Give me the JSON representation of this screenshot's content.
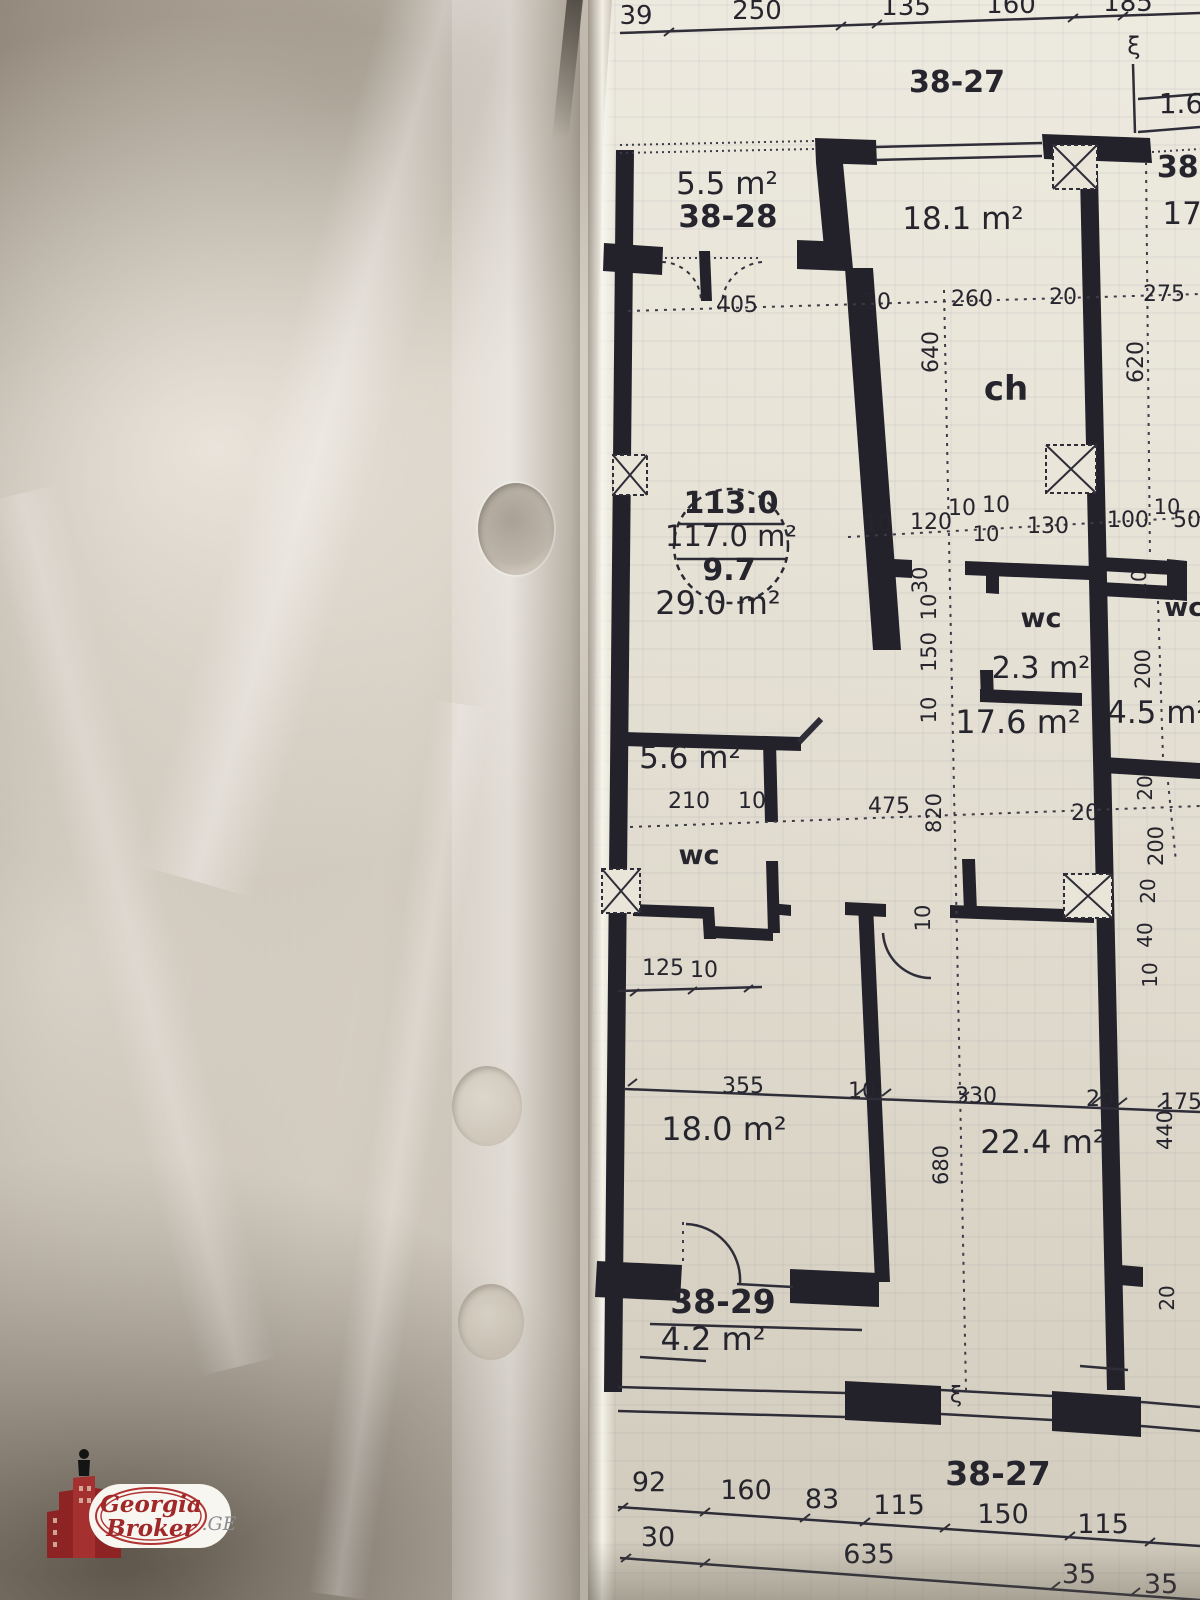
{
  "photo": {
    "description": "floor plan sheet in plastic sleeve"
  },
  "colors": {
    "wall_ink": "#23222b",
    "paper": "#e8e4d8",
    "brand_red": "#9e2727",
    "suffix_gray": "#8d8d94"
  },
  "watermark": {
    "brand_top": "Georgia",
    "brand_bottom": "Broker",
    "suffix": ".GE"
  },
  "plan": {
    "labels": [
      {
        "t": "38-27",
        "x": 957,
        "y": 92,
        "s": 30,
        "b": 1,
        "n": "unit-number-label"
      },
      {
        "t": "1.6",
        "x": 1181,
        "y": 113,
        "s": 28,
        "n": "dimension-label"
      },
      {
        "t": "5.5 m²",
        "x": 727,
        "y": 194,
        "s": 31,
        "n": "room-area-label"
      },
      {
        "t": "38-28",
        "x": 728,
        "y": 227,
        "s": 31,
        "b": 1,
        "n": "unit-number-label"
      },
      {
        "t": "18.1 m²",
        "x": 963,
        "y": 229,
        "s": 31,
        "n": "room-area-label"
      },
      {
        "t": "38-",
        "x": 1184,
        "y": 177,
        "s": 30,
        "b": 1,
        "n": "unit-number-label"
      },
      {
        "t": "17.",
        "x": 1187,
        "y": 224,
        "s": 31,
        "n": "room-area-label"
      },
      {
        "t": "ch",
        "x": 1006,
        "y": 400,
        "s": 34,
        "b": 1,
        "n": "room-name-label"
      },
      {
        "t": "113.0",
        "x": 731,
        "y": 513,
        "s": 30,
        "b": 1,
        "n": "area-stamp-value"
      },
      {
        "t": "117.0 m²",
        "x": 731,
        "y": 546,
        "s": 29,
        "n": "area-stamp-value"
      },
      {
        "t": "9.7",
        "x": 729,
        "y": 580,
        "s": 30,
        "b": 1,
        "n": "area-stamp-value"
      },
      {
        "t": "29.0 m²",
        "x": 718,
        "y": 614,
        "s": 32,
        "n": "room-area-label"
      },
      {
        "t": "wc",
        "x": 1041,
        "y": 627,
        "s": 27,
        "b": 1,
        "n": "room-name-label"
      },
      {
        "t": "2.3 m²",
        "x": 1041,
        "y": 678,
        "s": 30,
        "n": "room-area-label"
      },
      {
        "t": "17.6 m²",
        "x": 1018,
        "y": 733,
        "s": 32,
        "n": "room-area-label"
      },
      {
        "t": "wc",
        "x": 1184,
        "y": 616,
        "s": 26,
        "b": 1,
        "n": "room-name-label"
      },
      {
        "t": "4.5 m²",
        "x": 1158,
        "y": 723,
        "s": 31,
        "n": "room-area-label"
      },
      {
        "t": "5.6 m²",
        "x": 690,
        "y": 768,
        "s": 31,
        "n": "room-area-label"
      },
      {
        "t": "wc",
        "x": 699,
        "y": 864,
        "s": 27,
        "b": 1,
        "n": "room-name-label"
      },
      {
        "t": "18.0 m²",
        "x": 724,
        "y": 1140,
        "s": 32,
        "n": "room-area-label"
      },
      {
        "t": "22.4 m²",
        "x": 1043,
        "y": 1153,
        "s": 32,
        "n": "room-area-label"
      },
      {
        "t": "38-29",
        "x": 723,
        "y": 1313,
        "s": 33,
        "b": 1,
        "n": "unit-number-label"
      },
      {
        "t": "4.2 m²",
        "x": 713,
        "y": 1350,
        "s": 32,
        "n": "room-area-label"
      },
      {
        "t": "38-27",
        "x": 998,
        "y": 1485,
        "s": 33,
        "b": 1,
        "n": "unit-number-label"
      },
      {
        "t": "39",
        "x": 636,
        "y": 24,
        "s": 26
      },
      {
        "t": "250",
        "x": 757,
        "y": 19,
        "s": 26
      },
      {
        "t": "135",
        "x": 906,
        "y": 15,
        "s": 26
      },
      {
        "t": "160",
        "x": 1011,
        "y": 13,
        "s": 26
      },
      {
        "t": "185",
        "x": 1128,
        "y": 11,
        "s": 26
      },
      {
        "t": "405",
        "x": 737,
        "y": 312,
        "s": 22
      },
      {
        "t": "10",
        "x": 877,
        "y": 309,
        "s": 22
      },
      {
        "t": "260",
        "x": 972,
        "y": 306,
        "s": 22
      },
      {
        "t": "20",
        "x": 1063,
        "y": 304,
        "s": 22
      },
      {
        "t": "275",
        "x": 1164,
        "y": 301,
        "s": 22
      },
      {
        "t": "640",
        "x": 938,
        "y": 352,
        "s": 22,
        "r": -90
      },
      {
        "t": "620",
        "x": 1143,
        "y": 362,
        "s": 22,
        "r": -90
      },
      {
        "t": "10",
        "x": 878,
        "y": 531,
        "s": 22
      },
      {
        "t": "120",
        "x": 931,
        "y": 529,
        "s": 22
      },
      {
        "t": "10",
        "x": 962,
        "y": 515,
        "s": 22
      },
      {
        "t": "10",
        "x": 996,
        "y": 512,
        "s": 22
      },
      {
        "t": "10",
        "x": 986,
        "y": 541,
        "s": 21
      },
      {
        "t": "130",
        "x": 1048,
        "y": 533,
        "s": 22
      },
      {
        "t": "100",
        "x": 1128,
        "y": 527,
        "s": 22
      },
      {
        "t": "10",
        "x": 1167,
        "y": 514,
        "s": 21
      },
      {
        "t": "50",
        "x": 1187,
        "y": 527,
        "s": 22
      },
      {
        "t": "30",
        "x": 927,
        "y": 580,
        "s": 21,
        "r": -90
      },
      {
        "t": "10",
        "x": 936,
        "y": 607,
        "s": 21,
        "r": -90
      },
      {
        "t": "150",
        "x": 936,
        "y": 652,
        "s": 21,
        "r": -90
      },
      {
        "t": "10",
        "x": 936,
        "y": 710,
        "s": 21,
        "r": -90
      },
      {
        "t": "10",
        "x": 1146,
        "y": 582,
        "s": 20,
        "r": -90
      },
      {
        "t": "200",
        "x": 1150,
        "y": 669,
        "s": 21,
        "r": -90
      },
      {
        "t": "20",
        "x": 1152,
        "y": 788,
        "s": 20,
        "r": -90
      },
      {
        "t": "210",
        "x": 689,
        "y": 808,
        "s": 22
      },
      {
        "t": "10",
        "x": 752,
        "y": 808,
        "s": 22
      },
      {
        "t": "475",
        "x": 889,
        "y": 813,
        "s": 22
      },
      {
        "t": "820",
        "x": 941,
        "y": 813,
        "s": 21,
        "r": -90
      },
      {
        "t": "20",
        "x": 1085,
        "y": 820,
        "s": 22
      },
      {
        "t": "200",
        "x": 1163,
        "y": 846,
        "s": 21,
        "r": -90
      },
      {
        "t": "20",
        "x": 1155,
        "y": 891,
        "s": 20,
        "r": -90
      },
      {
        "t": "40",
        "x": 1152,
        "y": 935,
        "s": 20,
        "r": -90
      },
      {
        "t": "10",
        "x": 1157,
        "y": 975,
        "s": 20,
        "r": -90
      },
      {
        "t": "10",
        "x": 930,
        "y": 918,
        "s": 21,
        "r": -90
      },
      {
        "t": "125",
        "x": 663,
        "y": 975,
        "s": 22
      },
      {
        "t": "10",
        "x": 704,
        "y": 977,
        "s": 22
      },
      {
        "t": "355",
        "x": 743,
        "y": 1093,
        "s": 22
      },
      {
        "t": "10",
        "x": 862,
        "y": 1098,
        "s": 22
      },
      {
        "t": "330",
        "x": 976,
        "y": 1103,
        "s": 22
      },
      {
        "t": "20",
        "x": 1100,
        "y": 1106,
        "s": 22
      },
      {
        "t": "175",
        "x": 1181,
        "y": 1109,
        "s": 22
      },
      {
        "t": "440",
        "x": 1172,
        "y": 1130,
        "s": 21,
        "r": -90
      },
      {
        "t": "680",
        "x": 948,
        "y": 1165,
        "s": 21,
        "r": -90
      },
      {
        "t": "20",
        "x": 1174,
        "y": 1298,
        "s": 20,
        "r": -90
      },
      {
        "t": "92",
        "x": 649,
        "y": 1491,
        "s": 27
      },
      {
        "t": "160",
        "x": 746,
        "y": 1499,
        "s": 27
      },
      {
        "t": "83",
        "x": 822,
        "y": 1508,
        "s": 27
      },
      {
        "t": "115",
        "x": 899,
        "y": 1514,
        "s": 27
      },
      {
        "t": "150",
        "x": 1003,
        "y": 1523,
        "s": 27
      },
      {
        "t": "115",
        "x": 1103,
        "y": 1533,
        "s": 27
      },
      {
        "t": "30",
        "x": 658,
        "y": 1546,
        "s": 27
      },
      {
        "t": "635",
        "x": 869,
        "y": 1563,
        "s": 27
      },
      {
        "t": "35",
        "x": 1079,
        "y": 1583,
        "s": 27
      },
      {
        "t": "35",
        "x": 1161,
        "y": 1593,
        "s": 27
      },
      {
        "t": "ξ",
        "x": 1134,
        "y": 54,
        "s": 24,
        "n": "section-break-mark"
      },
      {
        "t": "ξ",
        "x": 956,
        "y": 1402,
        "s": 22,
        "n": "section-break-mark"
      }
    ]
  }
}
